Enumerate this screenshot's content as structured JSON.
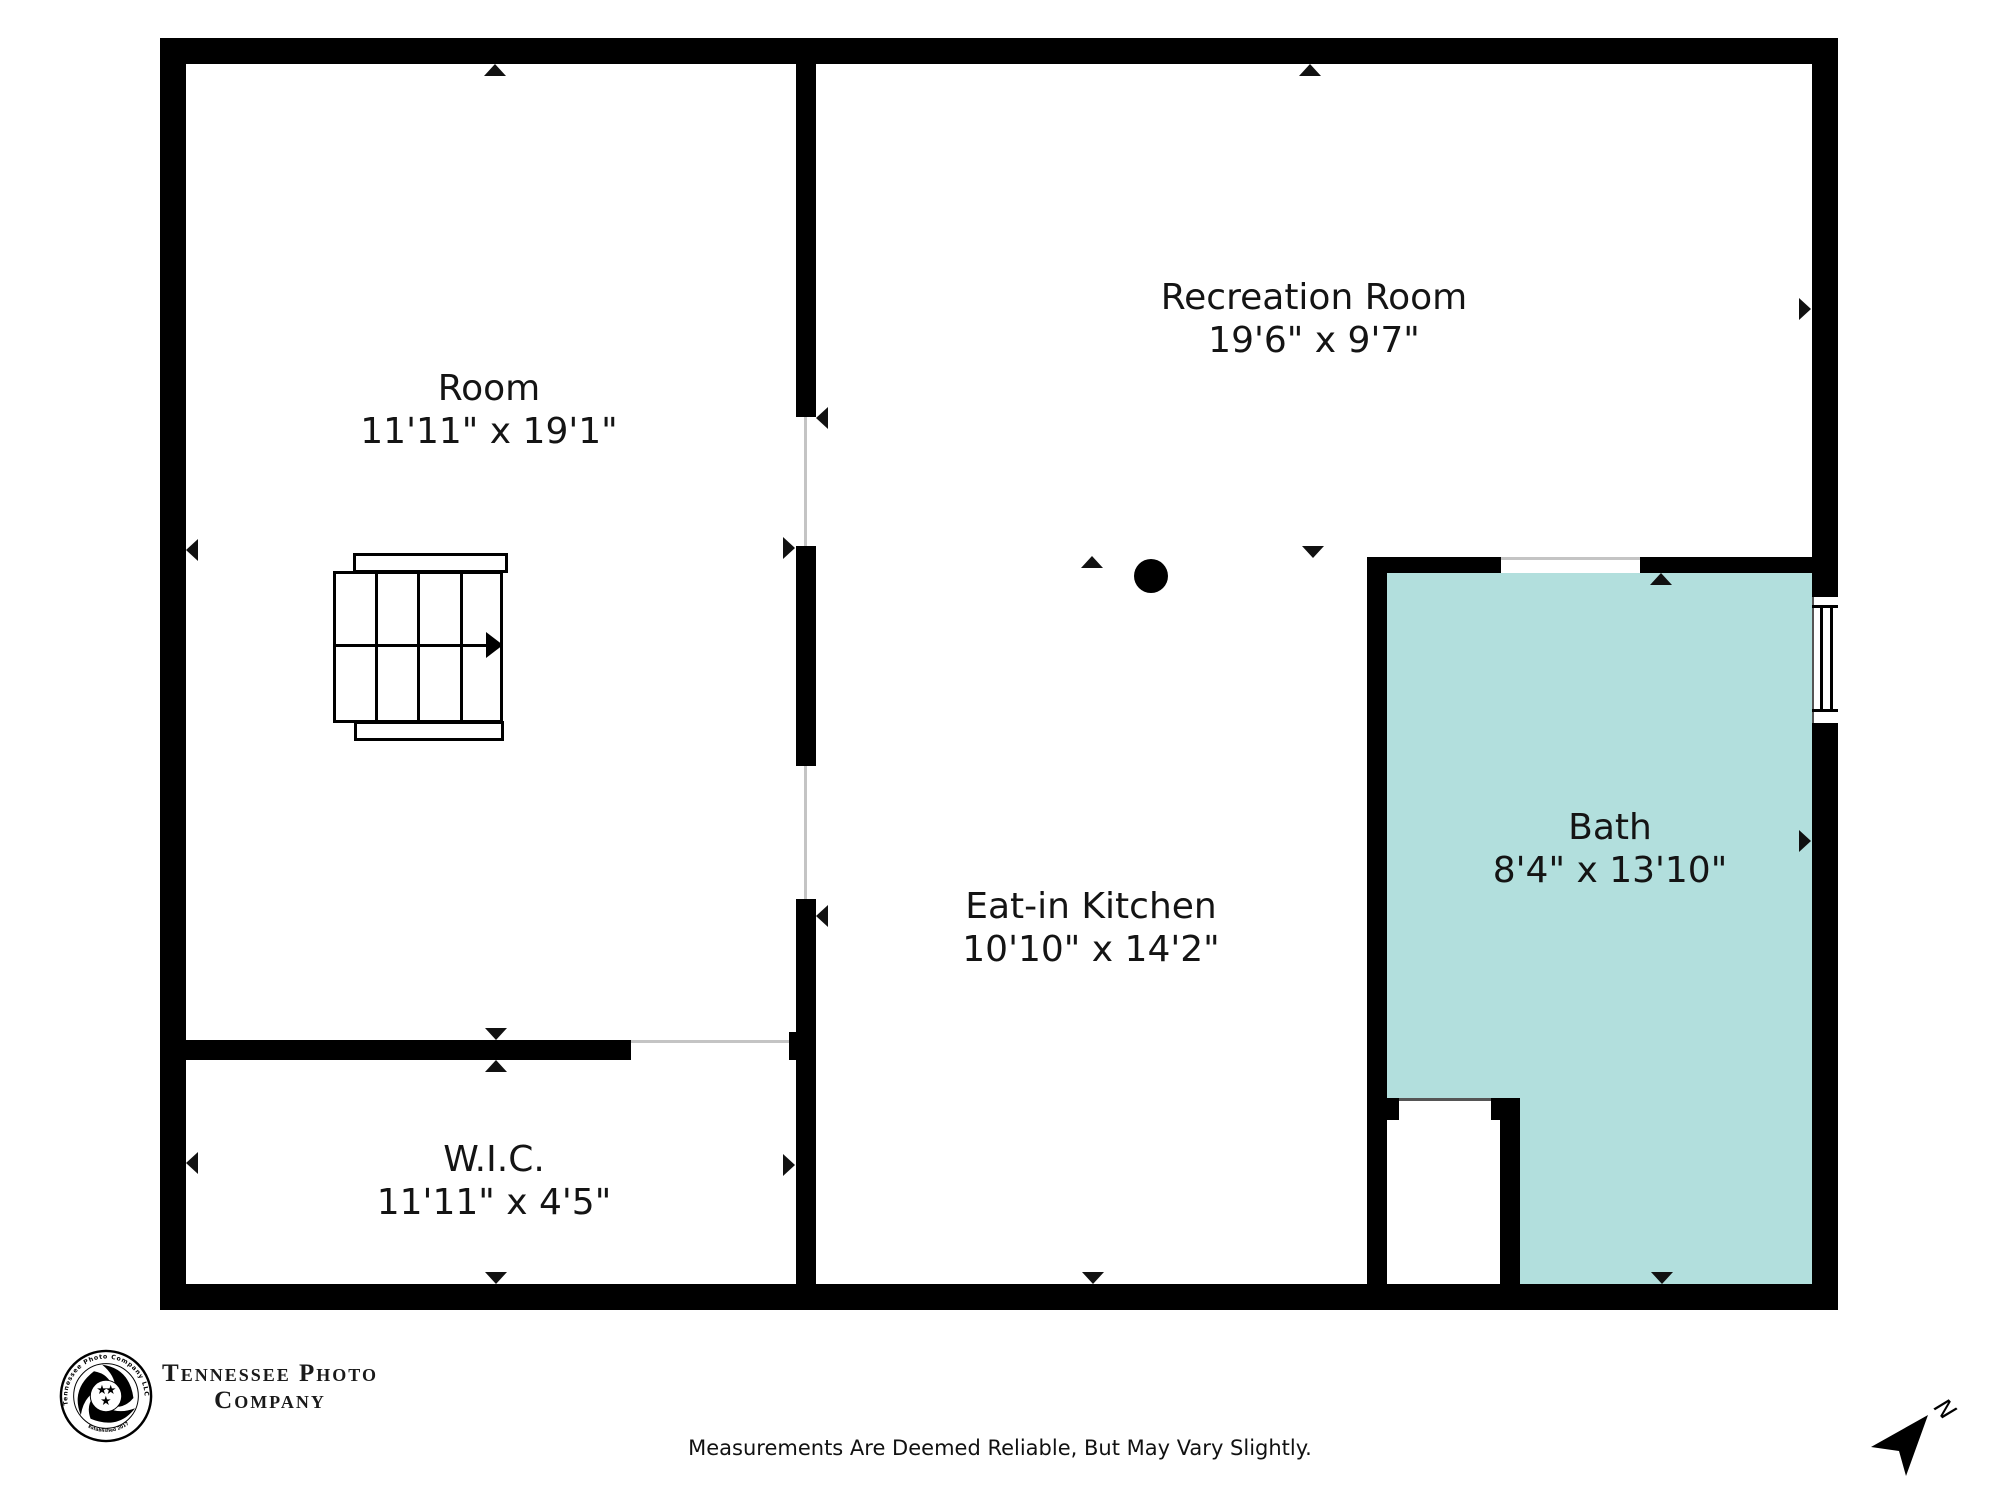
{
  "plan": {
    "rooms": [
      {
        "name": "Room",
        "dims": "11'11\" x 19'1\""
      },
      {
        "name": "Recreation Room",
        "dims": "19'6\" x 9'7\""
      },
      {
        "name": "Eat-in Kitchen",
        "dims": "10'10\" x 14'2\""
      },
      {
        "name": "Bath",
        "dims": "8'4\" x 13'10\""
      },
      {
        "name": "W.I.C.",
        "dims": "11'11\" x 4'5\""
      }
    ],
    "colors": {
      "wall": "#000000",
      "bath_fill": "#b2dfdd"
    }
  },
  "branding": {
    "wordmark_line1": "Tennessee Photo",
    "wordmark_line2": "Company",
    "emblem_text_top": "Tennessee Photo Company LLC",
    "emblem_text_bottom": "Established 2017"
  },
  "footer": {
    "disclaimer": "Measurements Are Deemed Reliable, But May Vary Slightly."
  },
  "compass": {
    "north_label": "N"
  }
}
